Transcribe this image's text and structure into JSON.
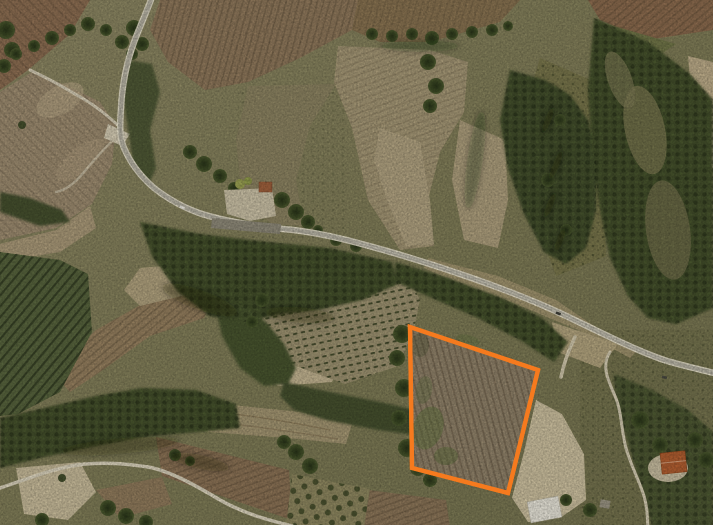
{
  "map": {
    "kind": "satellite-aerial-photo",
    "scene": "Rural hillside farmland seen from above: winding country road leading to a farmstead, a main road crossing toward the right edge, woods, vineyard rows, plowed fields and bare eroded slopes",
    "highlight": {
      "name": "parcel-boundary",
      "shape": "quadrilateral",
      "points": "410,327 538,370 508,493 412,468",
      "color": "#F57A1E",
      "stroke_width": 4.3
    },
    "features": [
      {
        "name": "country-road",
        "desc": "narrow winding road entering at top edge, curving down past the farmstead"
      },
      {
        "name": "main-road",
        "desc": "road running from the farmstead area diagonally to the right edge"
      },
      {
        "name": "farmstead",
        "desc": "farm buildings with light gravel courtyard beside the road"
      },
      {
        "name": "vineyard-rows",
        "desc": "field with regular rows of vines left of the highlighted parcel"
      },
      {
        "name": "olive-grove",
        "desc": "dark green grove with planted rows at the left edge"
      },
      {
        "name": "plowed-fields",
        "desc": "brown furrowed fields at top-left, top-center, top-right and bottom"
      },
      {
        "name": "woodland",
        "desc": "dark tree belts along roads, gullies and the right side"
      },
      {
        "name": "bare-slope",
        "desc": "light eroded ground right of the highlighted parcel"
      },
      {
        "name": "red-roof-house",
        "desc": "house with orange roof near bottom-right"
      },
      {
        "name": "white-roof-building",
        "desc": "white roofed building at bottom-center-right"
      },
      {
        "name": "dirt-tracks",
        "desc": "white dirt tracks at left, bottom-left and bottom-right"
      },
      {
        "name": "vehicles",
        "desc": "white van near farmstead, dark cars on the main road"
      }
    ],
    "palette": {
      "highlight_orange": "#F57A1E",
      "asphalt": "#B6B2A5",
      "road_casing": "#E8E1CF",
      "dirt_track": "#DCD3BD",
      "field_brown": "#8E765A",
      "field_red_brown": "#8B6B50",
      "field_tan": "#A59776",
      "parcel_soil": "#8F8069",
      "woods_dark": "#3C4827",
      "scrub_olive": "#7D7A55",
      "bare_ground": "#CDC0A0",
      "roof_red": "#B25B2D",
      "roof_white": "#EBE8DE"
    }
  }
}
